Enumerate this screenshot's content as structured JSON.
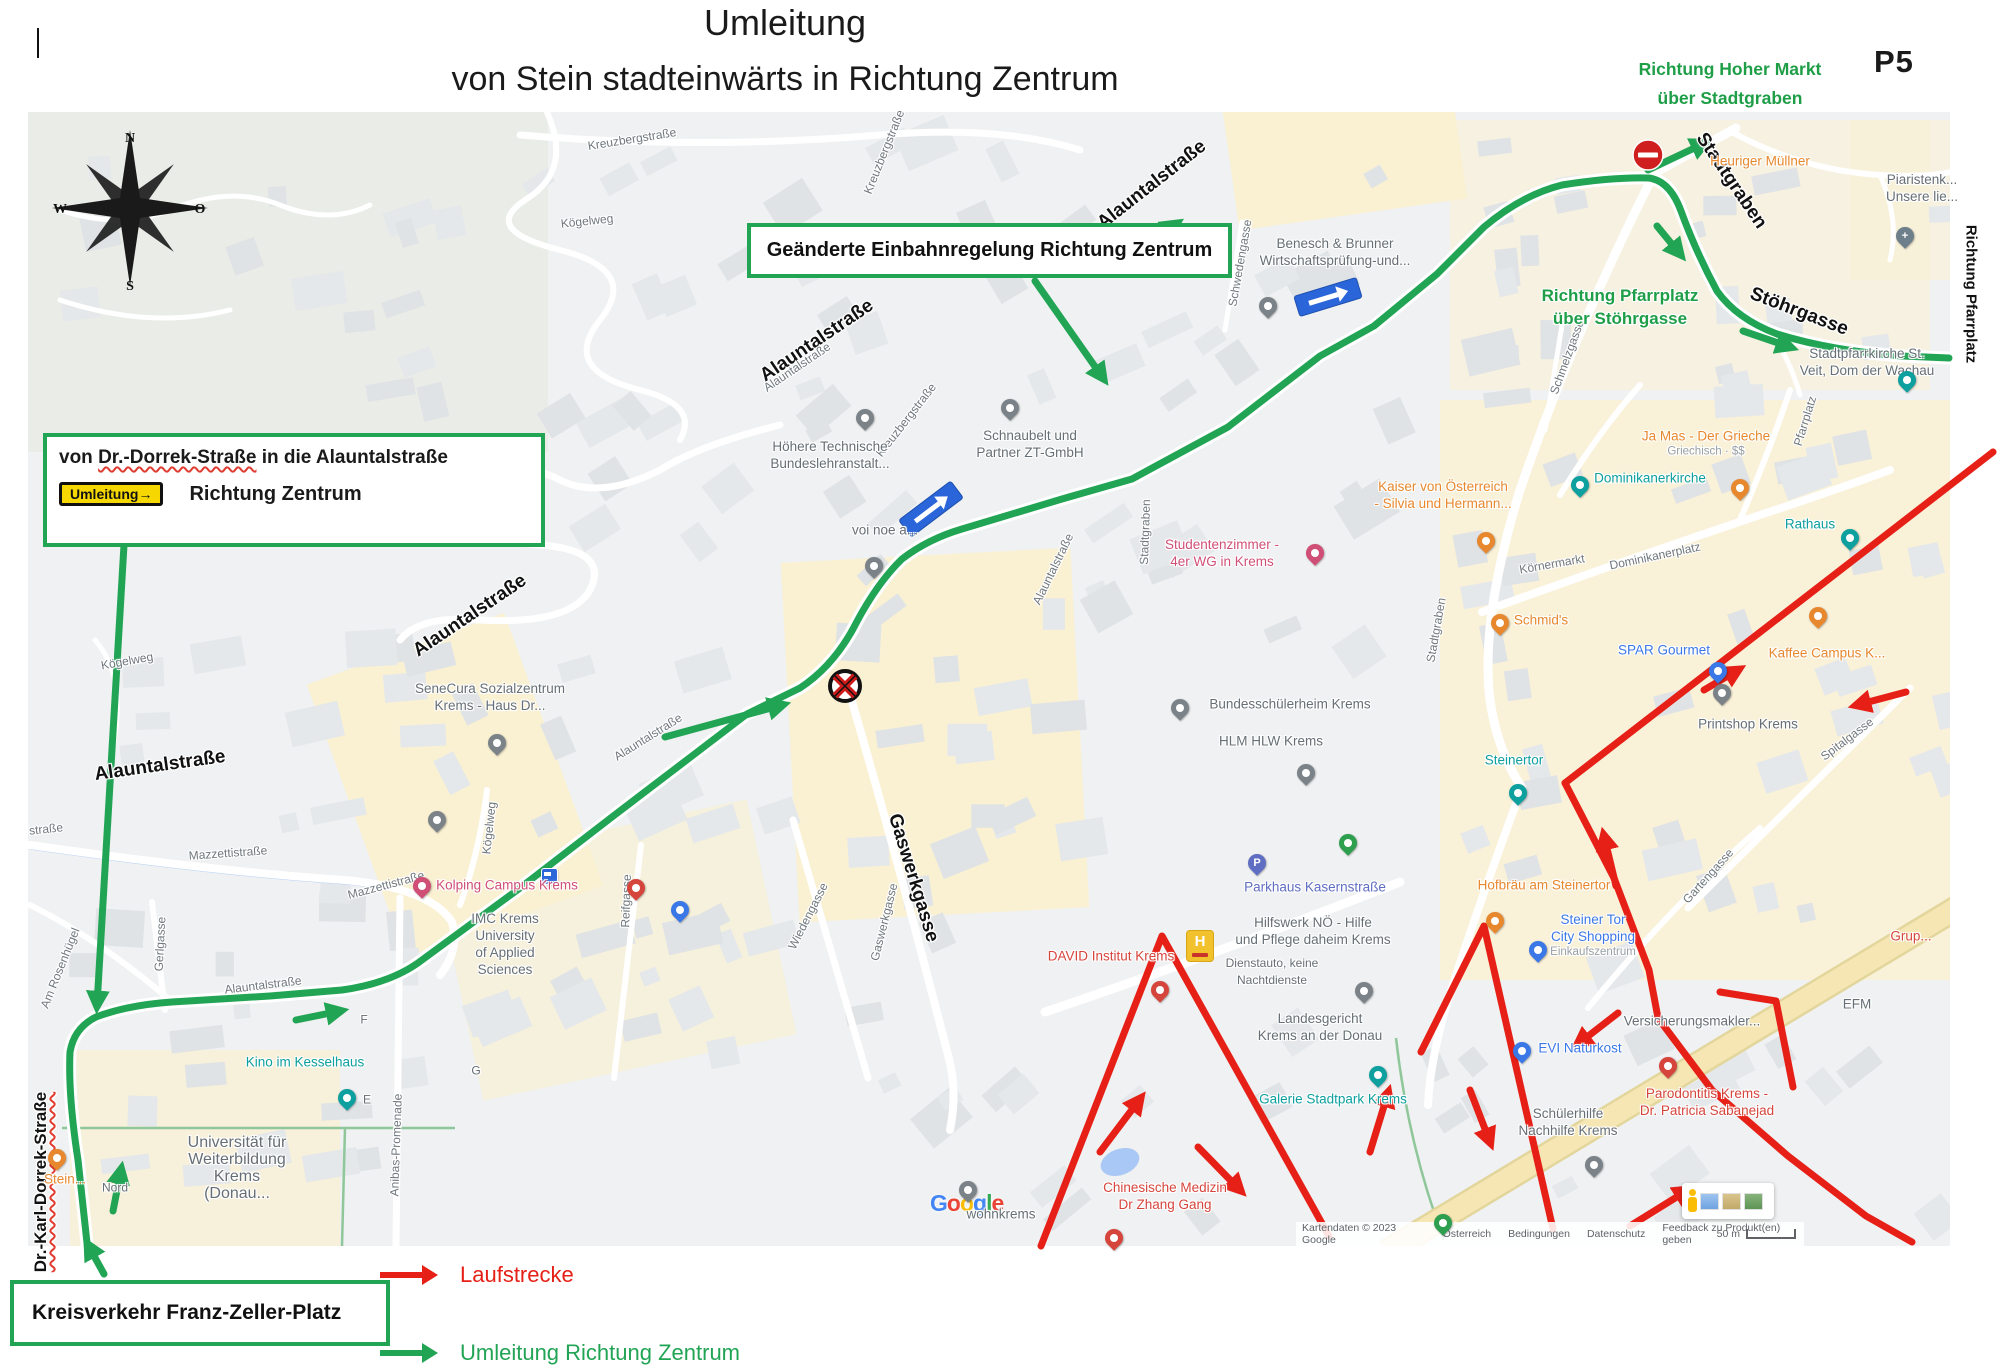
{
  "header": {
    "title": "Umleitung",
    "subtitle": "von Stein stadteinwärts in Richtung Zentrum",
    "page_code": "P5",
    "top_right": [
      "Richtung Hoher Markt",
      "über Stadtgraben"
    ]
  },
  "boxes": {
    "einbahn": "Geänderte Einbahnregelung Richtung Zentrum",
    "dorrek_pre": "von ",
    "dorrek_word": "Dr.-Dorrek-Straße",
    "dorrek_post": " in die Alauntalstraße",
    "umleitung_sign": "Umleitung→",
    "dorrek_line2": "Richtung Zentrum",
    "kreisverkehr": "Kreisverkehr Franz-Zeller-Platz"
  },
  "legend": {
    "items": [
      {
        "label": "Laufstrecke",
        "color": "#e62017"
      },
      {
        "label": "Umleitung Richtung Zentrum",
        "color": "#22a455"
      }
    ]
  },
  "compass": {
    "n": "N",
    "e": "O",
    "s": "S",
    "w": "W"
  },
  "route_colors": {
    "detour_green": "#22a455",
    "run_red": "#e62017"
  },
  "map": {
    "notes": [
      {
        "lines": [
          "Richtung Pfarrplatz",
          "über Stöhrgasse"
        ],
        "x": 1620,
        "y": 307
      }
    ],
    "streets_bold": [
      {
        "t": "Alauntalstraße",
        "x": 1152,
        "y": 185,
        "r": -38
      },
      {
        "t": "Alauntalstraße",
        "x": 817,
        "y": 341,
        "r": -34
      },
      {
        "t": "Alauntalstraße",
        "x": 470,
        "y": 616,
        "r": -34
      },
      {
        "t": "Alauntalstraße",
        "x": 160,
        "y": 766,
        "r": -8
      },
      {
        "t": "Stadtgraben",
        "x": 1731,
        "y": 181,
        "r": 56
      },
      {
        "t": "Stöhrgasse",
        "x": 1799,
        "y": 312,
        "r": 21
      },
      {
        "t": "Gaswerkgasse",
        "x": 913,
        "y": 878,
        "r": 73
      },
      {
        "t": "Dr.-Karl-Dorrek-Straße",
        "x": 41,
        "y": 1182,
        "r": -90,
        "fs": 17,
        "wavy": true
      },
      {
        "t": "Richtung Pfarrplatz",
        "x": 1971,
        "y": 294,
        "r": 90,
        "fs": 15
      }
    ],
    "streets": [
      {
        "t": "Kreuzbergstraße",
        "x": 632,
        "y": 139,
        "r": -9
      },
      {
        "t": "Kreuzbergstraße",
        "x": 884,
        "y": 152,
        "r": -68
      },
      {
        "t": "Kreuzbergstraße",
        "x": 906,
        "y": 420,
        "r": -52
      },
      {
        "t": "Kögelweg",
        "x": 587,
        "y": 221,
        "r": -6
      },
      {
        "t": "Kögelweg",
        "x": 489,
        "y": 828,
        "r": -84
      },
      {
        "t": "Kögelweg",
        "x": 127,
        "y": 661,
        "r": -10
      },
      {
        "t": "Mazzettistraße",
        "x": 228,
        "y": 853,
        "r": -4
      },
      {
        "t": "Mazzettistraße",
        "x": 386,
        "y": 885,
        "r": -15
      },
      {
        "t": "Gerlgasse",
        "x": 160,
        "y": 944,
        "r": -87
      },
      {
        "t": "Am Rosenhügel",
        "x": 60,
        "y": 968,
        "r": -68
      },
      {
        "t": "straße",
        "x": 46,
        "y": 829,
        "r": -6
      },
      {
        "t": "Alauntalstraße",
        "x": 797,
        "y": 367,
        "r": -34
      },
      {
        "t": "Alauntalstraße",
        "x": 648,
        "y": 737,
        "r": -32
      },
      {
        "t": "Alauntalstraße",
        "x": 263,
        "y": 985,
        "r": -7
      },
      {
        "t": "Alauntalstraße",
        "x": 1053,
        "y": 569,
        "r": -64
      },
      {
        "t": "Wiedengasse",
        "x": 808,
        "y": 916,
        "r": -63
      },
      {
        "t": "Reifgasse",
        "x": 626,
        "y": 901,
        "r": -88
      },
      {
        "t": "Gaswerkgasse",
        "x": 884,
        "y": 922,
        "r": -76
      },
      {
        "t": "Stadtgraben",
        "x": 1145,
        "y": 532,
        "r": -88
      },
      {
        "t": "Stadtgraben",
        "x": 1436,
        "y": 630,
        "r": -80
      },
      {
        "t": "Schmelzgasse",
        "x": 1567,
        "y": 357,
        "r": -70
      },
      {
        "t": "Schwedengasse",
        "x": 1240,
        "y": 263,
        "r": -80
      },
      {
        "t": "Körnermarkt",
        "x": 1552,
        "y": 564,
        "r": -10
      },
      {
        "t": "Dominikanerplatz",
        "x": 1655,
        "y": 556,
        "r": -12
      },
      {
        "t": "Pfarrplatz",
        "x": 1805,
        "y": 421,
        "r": -73
      },
      {
        "t": "Spitalgasse",
        "x": 1847,
        "y": 739,
        "r": -37
      },
      {
        "t": "Gartengasse",
        "x": 1708,
        "y": 876,
        "r": -48
      },
      {
        "t": "Anibas-Promenade",
        "x": 396,
        "y": 1145,
        "r": -88
      }
    ],
    "pois": [
      {
        "lines": [
          "Heuriger Müllner"
        ],
        "c": "orange",
        "x": 1760,
        "y": 161
      },
      {
        "lines": [
          "Piaristenk...",
          "Unsere lie..."
        ],
        "c": "gray",
        "x": 1922,
        "y": 188
      },
      {
        "lines": [
          "Stadtpfarrkirche St.",
          "Veit, Dom der Wachau"
        ],
        "c": "gray",
        "x": 1867,
        "y": 362
      },
      {
        "lines": [
          "Benesch & Brunner",
          "Wirtschaftsprüfung-und..."
        ],
        "c": "gray",
        "x": 1335,
        "y": 252
      },
      {
        "lines": [
          "voi noe a..."
        ],
        "c": "gray",
        "x": 885,
        "y": 530
      },
      {
        "lines": [
          "Schnaubelt und",
          "Partner ZT-GmbH"
        ],
        "c": "gray",
        "x": 1030,
        "y": 444
      },
      {
        "lines": [
          "Höhere Technische",
          "Bundeslehranstalt..."
        ],
        "c": "gray",
        "x": 830,
        "y": 455
      },
      {
        "lines": [
          "Studentenzimmer -",
          "4er WG in Krems"
        ],
        "c": "pink",
        "x": 1222,
        "y": 553
      },
      {
        "lines": [
          "SeneCura Sozialzentrum",
          "Krems - Haus Dr..."
        ],
        "c": "gray",
        "x": 490,
        "y": 697
      },
      {
        "lines": [
          "Kaiser von Österreich",
          "- Silvia und Hermann..."
        ],
        "c": "orange",
        "x": 1443,
        "y": 495
      },
      {
        "lines": [
          "Ja Mas - Der Grieche"
        ],
        "c": "orange",
        "x": 1706,
        "y": 443,
        "sub": [
          "Griechisch · $$"
        ]
      },
      {
        "lines": [
          "Dominikanerkirche"
        ],
        "c": "teal",
        "x": 1650,
        "y": 478
      },
      {
        "lines": [
          "Rathaus"
        ],
        "c": "teal",
        "x": 1810,
        "y": 524
      },
      {
        "lines": [
          "Schmid's"
        ],
        "c": "orange",
        "x": 1541,
        "y": 620
      },
      {
        "lines": [
          "SPAR Gourmet"
        ],
        "c": "blue",
        "x": 1664,
        "y": 650
      },
      {
        "lines": [
          "Kaffee Campus K..."
        ],
        "c": "orange",
        "x": 1827,
        "y": 653
      },
      {
        "lines": [
          "Printshop Krems"
        ],
        "c": "gray",
        "x": 1748,
        "y": 724
      },
      {
        "lines": [
          "Steinertor"
        ],
        "c": "teal",
        "x": 1514,
        "y": 760
      },
      {
        "lines": [
          "Hofbräu am Steinertor"
        ],
        "c": "orange",
        "x": 1544,
        "y": 885
      },
      {
        "lines": [
          "Steiner Tor",
          "City Shopping"
        ],
        "c": "blue",
        "x": 1593,
        "y": 935,
        "sub": [
          "Einkaufszentrum"
        ]
      },
      {
        "lines": [
          "Grup..."
        ],
        "c": "red",
        "x": 1911,
        "y": 936
      },
      {
        "lines": [
          "EFM"
        ],
        "c": "gray",
        "x": 1857,
        "y": 1004
      },
      {
        "lines": [
          "Versicherungsmakler..."
        ],
        "c": "gray",
        "x": 1692,
        "y": 1021
      },
      {
        "lines": [
          "EVI Naturkost"
        ],
        "c": "blue",
        "x": 1580,
        "y": 1048
      },
      {
        "lines": [
          "Parodontitis Krems -",
          "Dr. Patricia Sabanejad"
        ],
        "c": "red",
        "x": 1707,
        "y": 1102
      },
      {
        "lines": [
          "Schülerhilfe",
          "Nachhilfe Krems"
        ],
        "c": "gray",
        "x": 1568,
        "y": 1122
      },
      {
        "lines": [
          "Galerie Stadtpark Krems"
        ],
        "c": "teal",
        "x": 1333,
        "y": 1099
      },
      {
        "lines": [
          "Landesgericht",
          "Krems an der Donau"
        ],
        "c": "gray",
        "x": 1320,
        "y": 1027
      },
      {
        "lines": [
          "Parkhaus Kasernstraße"
        ],
        "c": "purple",
        "x": 1315,
        "y": 887
      },
      {
        "lines": [
          "Hilfswerk NÖ - Hilfe",
          "und Pflege daheim Krems"
        ],
        "c": "gray",
        "x": 1313,
        "y": 931
      },
      {
        "lines": [
          "Dienstauto, keine",
          "Nachtdienste"
        ],
        "c": "gray",
        "x": 1272,
        "y": 972,
        "fs": 12
      },
      {
        "lines": [
          "DAVID Institut Krems"
        ],
        "c": "red",
        "x": 1111,
        "y": 956
      },
      {
        "lines": [
          "Bundesschülerheim Krems"
        ],
        "c": "gray",
        "x": 1290,
        "y": 704
      },
      {
        "lines": [
          "HLM HLW Krems"
        ],
        "c": "gray",
        "x": 1271,
        "y": 741
      },
      {
        "lines": [
          "IMC Krems",
          "University",
          "of Applied",
          "Sciences"
        ],
        "c": "gray",
        "x": 505,
        "y": 944
      },
      {
        "lines": [
          "Kino im Kesselhaus"
        ],
        "c": "teal",
        "x": 305,
        "y": 1062
      },
      {
        "lines": [
          "Universität für",
          "Weiterbildung",
          "Krems",
          "(Donau..."
        ],
        "c": "gray",
        "x": 237,
        "y": 1168,
        "fs": 16
      },
      {
        "lines": [
          "Nord"
        ],
        "c": "gray",
        "x": 115,
        "y": 1188,
        "fs": 12
      },
      {
        "lines": [
          "Stein..."
        ],
        "c": "orange",
        "x": 65,
        "y": 1179
      },
      {
        "lines": [
          "Kolping Campus Krems"
        ],
        "c": "pink",
        "x": 507,
        "y": 885
      },
      {
        "lines": [
          "wohnkrems"
        ],
        "c": "gray",
        "x": 1001,
        "y": 1214
      },
      {
        "lines": [
          "Chinesische Medizin",
          "Dr Zhang Gang"
        ],
        "c": "red",
        "x": 1165,
        "y": 1196
      },
      {
        "lines": [
          "F"
        ],
        "c": "gray",
        "x": 364,
        "y": 1020,
        "fs": 12
      },
      {
        "lines": [
          "E"
        ],
        "c": "gray",
        "x": 367,
        "y": 1100,
        "fs": 12
      },
      {
        "lines": [
          "G"
        ],
        "c": "gray",
        "x": 476,
        "y": 1071,
        "fs": 12
      }
    ],
    "pins": [
      {
        "x": 1905,
        "y": 248,
        "c": "#6d7f8a",
        "g": "+"
      },
      {
        "x": 1907,
        "y": 392,
        "c": "#0e9f9f"
      },
      {
        "x": 1268,
        "y": 318,
        "c": "#7b8389"
      },
      {
        "x": 874,
        "y": 578,
        "c": "#7b8389"
      },
      {
        "x": 1010,
        "y": 420,
        "c": "#7b8389"
      },
      {
        "x": 865,
        "y": 430,
        "c": "#7b8389"
      },
      {
        "x": 1315,
        "y": 565,
        "c": "#d04f77"
      },
      {
        "x": 497,
        "y": 755,
        "c": "#7b8389"
      },
      {
        "x": 1486,
        "y": 553,
        "c": "#e8882e"
      },
      {
        "x": 1740,
        "y": 500,
        "c": "#e8882e"
      },
      {
        "x": 1580,
        "y": 497,
        "c": "#0e9f9f"
      },
      {
        "x": 1850,
        "y": 550,
        "c": "#0e9f9f"
      },
      {
        "x": 1500,
        "y": 635,
        "c": "#e8882e"
      },
      {
        "x": 1718,
        "y": 683,
        "c": "#3b78e7"
      },
      {
        "x": 1818,
        "y": 628,
        "c": "#e8882e"
      },
      {
        "x": 1722,
        "y": 705,
        "c": "#7b8389"
      },
      {
        "x": 1518,
        "y": 805,
        "c": "#0e9f9f"
      },
      {
        "x": 1495,
        "y": 933,
        "c": "#e8882e"
      },
      {
        "x": 1538,
        "y": 962,
        "c": "#3b78e7"
      },
      {
        "x": 1522,
        "y": 1063,
        "c": "#3b78e7"
      },
      {
        "x": 1668,
        "y": 1078,
        "c": "#d6453c"
      },
      {
        "x": 1594,
        "y": 1177,
        "c": "#7b8389"
      },
      {
        "x": 1378,
        "y": 1087,
        "c": "#0e9f9f"
      },
      {
        "x": 1364,
        "y": 1003,
        "c": "#7b8389"
      },
      {
        "x": 1257,
        "y": 875,
        "c": "#5f6dc3",
        "g": "P"
      },
      {
        "x": 1160,
        "y": 1002,
        "c": "#d6453c"
      },
      {
        "x": 1180,
        "y": 720,
        "c": "#7b8389"
      },
      {
        "x": 1306,
        "y": 785,
        "c": "#7b8389"
      },
      {
        "x": 1348,
        "y": 855,
        "c": "#2e9e4f"
      },
      {
        "x": 1443,
        "y": 1235,
        "c": "#2e9e4f"
      },
      {
        "x": 437,
        "y": 832,
        "c": "#7b8389"
      },
      {
        "x": 347,
        "y": 1110,
        "c": "#0e9f9f"
      },
      {
        "x": 57,
        "y": 1170,
        "c": "#e8882e"
      },
      {
        "x": 422,
        "y": 898,
        "c": "#d04f77"
      },
      {
        "x": 636,
        "y": 900,
        "c": "#d6453c"
      },
      {
        "x": 680,
        "y": 922,
        "c": "#3b78e7"
      },
      {
        "x": 968,
        "y": 1202,
        "c": "#7b8389"
      },
      {
        "x": 1114,
        "y": 1250,
        "c": "#d6453c"
      }
    ],
    "attribution": [
      "Kartendaten © 2023 Google",
      "Österreich",
      "Bedingungen",
      "Datenschutz",
      "Feedback zu Produkt(en) geben"
    ],
    "scale_label": "50 m",
    "google_logo": [
      {
        "ch": "G",
        "c": "#4285F4"
      },
      {
        "ch": "o",
        "c": "#EA4335"
      },
      {
        "ch": "o",
        "c": "#FBBC05"
      },
      {
        "ch": "g",
        "c": "#4285F4"
      },
      {
        "ch": "l",
        "c": "#34A853"
      },
      {
        "ch": "e",
        "c": "#EA4335"
      }
    ]
  }
}
